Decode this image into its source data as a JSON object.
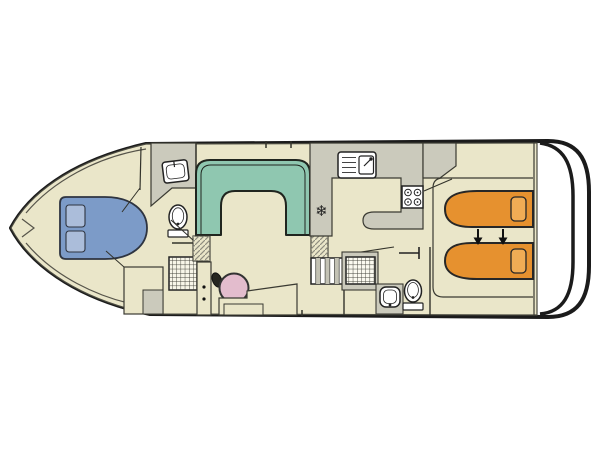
{
  "diagram": {
    "icons": {
      "fridge": "❄"
    },
    "colors": {
      "hull": "#1b1b1b",
      "floor": "#eae6c9",
      "fixture_gray": "#cbcabc",
      "sofa_teal": "#8fc7b0",
      "bed_blue": "#7c9bc8",
      "pillow_blue": "#abbdda",
      "bed_orange": "#e6912f",
      "pillow_orange": "#f0ac55",
      "wheel_pink": "#e3bccd",
      "fixture_white": "#ffffff",
      "outline": "#33332b"
    }
  }
}
